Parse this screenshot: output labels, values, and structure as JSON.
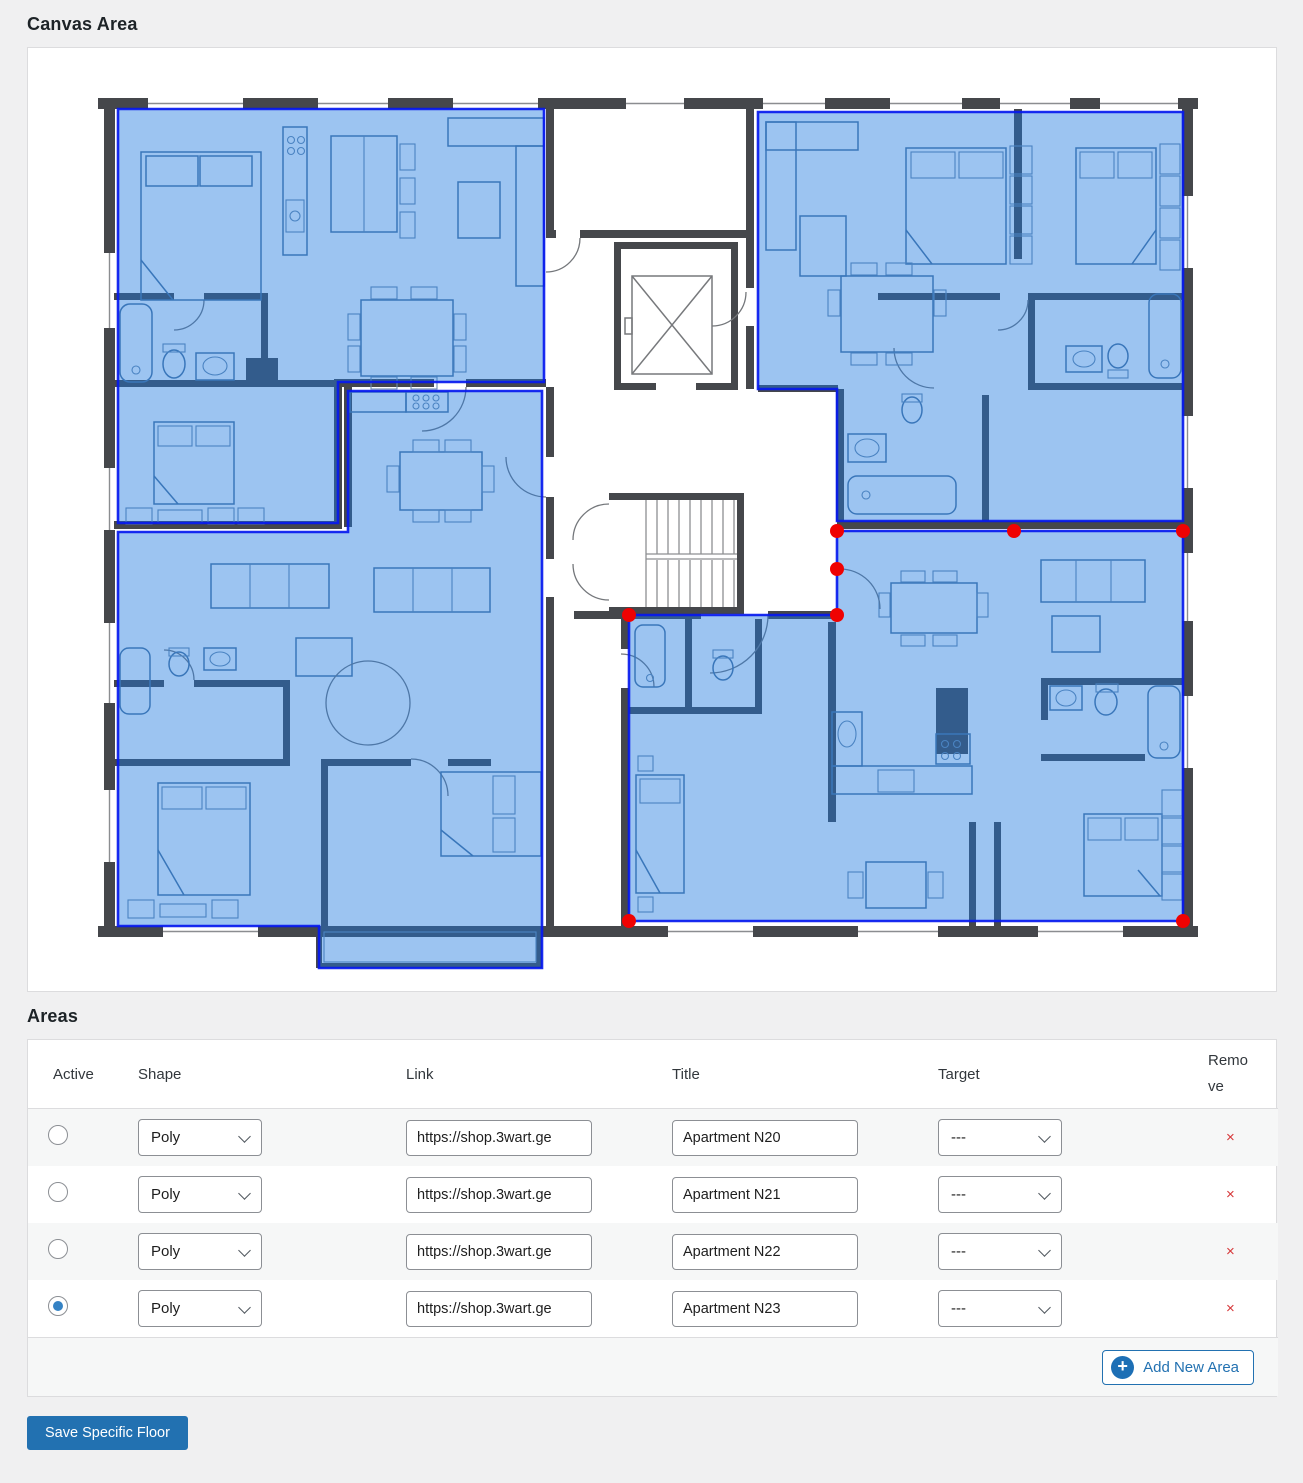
{
  "canvas": {
    "title": "Canvas Area"
  },
  "areas": {
    "title": "Areas",
    "headers": [
      "Active",
      "Shape",
      "Link",
      "Title",
      "Target",
      "Remove"
    ],
    "rows": [
      {
        "active": false,
        "shape": "Poly",
        "link": "https://shop.3wart.ge",
        "title": "Apartment N20",
        "target": "---",
        "remove": "×"
      },
      {
        "active": false,
        "shape": "Poly",
        "link": "https://shop.3wart.ge",
        "title": "Apartment N21",
        "target": "---",
        "remove": "×"
      },
      {
        "active": false,
        "shape": "Poly",
        "link": "https://shop.3wart.ge",
        "title": "Apartment N22",
        "target": "---",
        "remove": "×"
      },
      {
        "active": true,
        "shape": "Poly",
        "link": "https://shop.3wart.ge",
        "title": "Apartment N23",
        "target": "---",
        "remove": "×"
      }
    ],
    "add_button_label": "Add New Area"
  },
  "save_button_label": "Save Specific Floor",
  "colors": {
    "accent": "#2271b1",
    "remove": "#d63638",
    "overlay_fill": "#1e78e0",
    "overlay_stroke": "#0619ef",
    "handle": "#ef0202"
  },
  "floorplan": {
    "areas": [
      {
        "title": "Apartment N20",
        "active": false,
        "points": "90,61 516,61 516,334 310,334 310,475 90,475"
      },
      {
        "title": "Apartment N21",
        "active": false,
        "points": "320,343 514,343 514,920 291,920 291,878 90,878 90,484 320,484"
      },
      {
        "title": "Apartment N22",
        "active": false,
        "points": "730,64 1155,64 1155,473 809,473 809,341 730,341"
      },
      {
        "title": "Apartment N23",
        "active": true,
        "points": "809,483 1155,483 1155,873 601,873 601,567 809,567"
      }
    ],
    "handles": [
      [
        809,
        483
      ],
      [
        986,
        483
      ],
      [
        1155,
        483
      ],
      [
        809,
        521
      ],
      [
        809,
        567
      ],
      [
        601,
        567
      ],
      [
        601,
        873
      ],
      [
        1155,
        873
      ]
    ]
  }
}
